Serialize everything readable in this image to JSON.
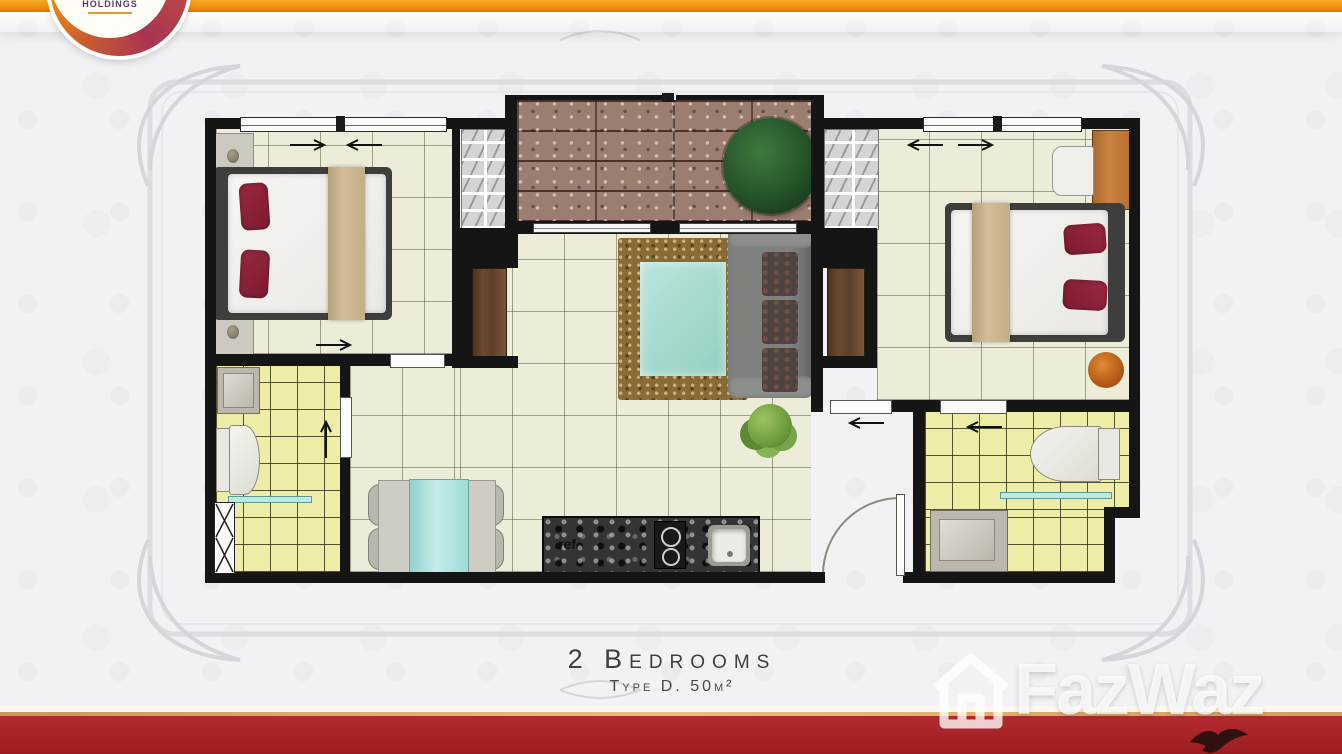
{
  "header": {
    "logo": {
      "line1": "HEIGHTS",
      "line2": "HOLDINGS"
    },
    "bar_color": "#ef8c07"
  },
  "caption": {
    "title": "2 Bedrooms",
    "subtitle": "Type D. 50m²"
  },
  "floorplan": {
    "view": "top-down 2-bedroom unit floor plan",
    "rooms": [
      "bedroom-left",
      "bedroom-right",
      "living-room",
      "dining-area",
      "kitchen",
      "bathroom-left",
      "bathroom-right",
      "balcony"
    ],
    "labels": {
      "refrigerator": "ref"
    }
  },
  "watermark": {
    "brand": "FazWaz",
    "icon": "house-outline-icon"
  },
  "footer": {
    "band_color": "#9c1d21",
    "gold_line_color": "#d8a65f"
  },
  "colors": {
    "wall": "#151515",
    "floor_cream": "#edecd9",
    "bath_yellow": "#ededa8",
    "balcony_brick": "#9c7d71",
    "pillow_red": "#8e2138",
    "rug_brown": "#8a6a35",
    "glass_teal": "#a8ddd5",
    "sofa_gray": "#7f817e",
    "wood_wardrobe": "#6b4a31",
    "footer_red": "#9c1d21",
    "accent_orange": "#ef8c07"
  }
}
